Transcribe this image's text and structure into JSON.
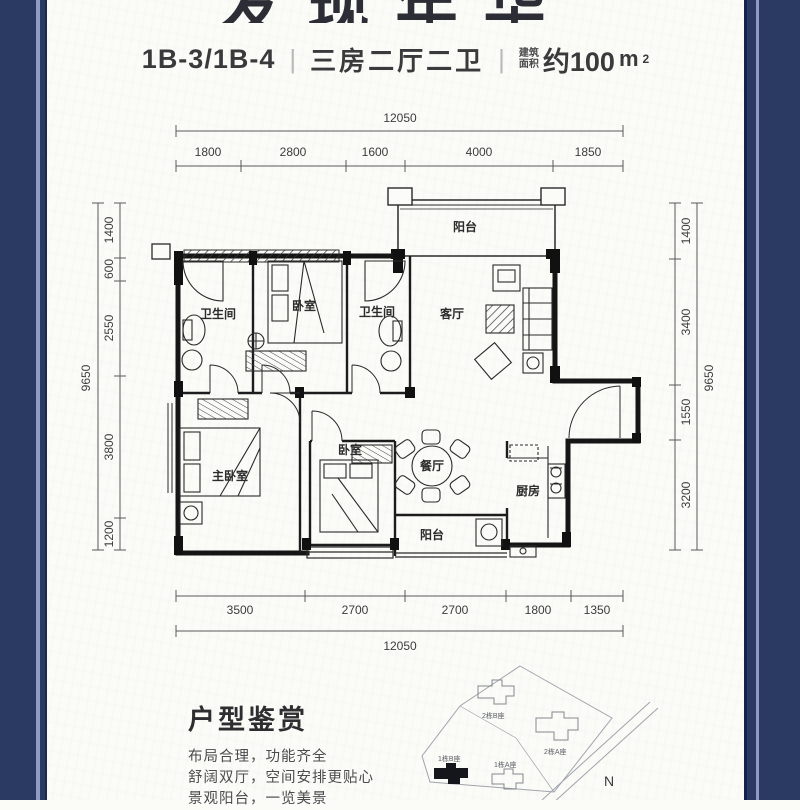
{
  "header": {
    "title_cropped": "发现年华",
    "unit_code": "1B-3/1B-4",
    "layout_desc": "三房二厅二卫",
    "separator": "|",
    "area_label_line1": "建筑",
    "area_label_line2": "面积",
    "area_value": "约100",
    "area_unit": "m",
    "area_sup": "2"
  },
  "plan": {
    "dims_top": {
      "total": "12050",
      "segments": [
        "1800",
        "2800",
        "1600",
        "4000",
        "1850"
      ]
    },
    "dims_bottom": {
      "total": "12050",
      "segments": [
        "3500",
        "2700",
        "2700",
        "1800",
        "1350"
      ]
    },
    "dims_left": {
      "total": "9650",
      "segments": [
        "1400",
        "600",
        "2550",
        "3800",
        "1200"
      ]
    },
    "dims_right": {
      "total": "9650",
      "segments": [
        "1400",
        "3400",
        "1550",
        "3200"
      ]
    },
    "rooms": {
      "balcony_top": "阳台",
      "bath_left": "卫生间",
      "bedroom_top": "卧室",
      "bath_right": "卫生间",
      "living": "客厅",
      "master_bedroom": "主卧室",
      "bedroom_mid": "卧室",
      "dining": "餐厅",
      "kitchen": "厨房",
      "balcony_bottom": "阳台"
    }
  },
  "appreciation": {
    "heading": "户型鉴赏",
    "lines": [
      "布局合理，功能齐全",
      "舒阔双厅，空间安排更贴心",
      "景观阳台，一览美景"
    ]
  },
  "siteplan": {
    "building_2b": "2栋B座",
    "building_2a": "2栋A座",
    "building_1b": "1栋B座",
    "building_1a": "1栋A座",
    "compass": "N"
  },
  "colors": {
    "border_navy": "#2b3a63",
    "border_light": "#8d9cc0",
    "ink": "#1f1f1f"
  }
}
